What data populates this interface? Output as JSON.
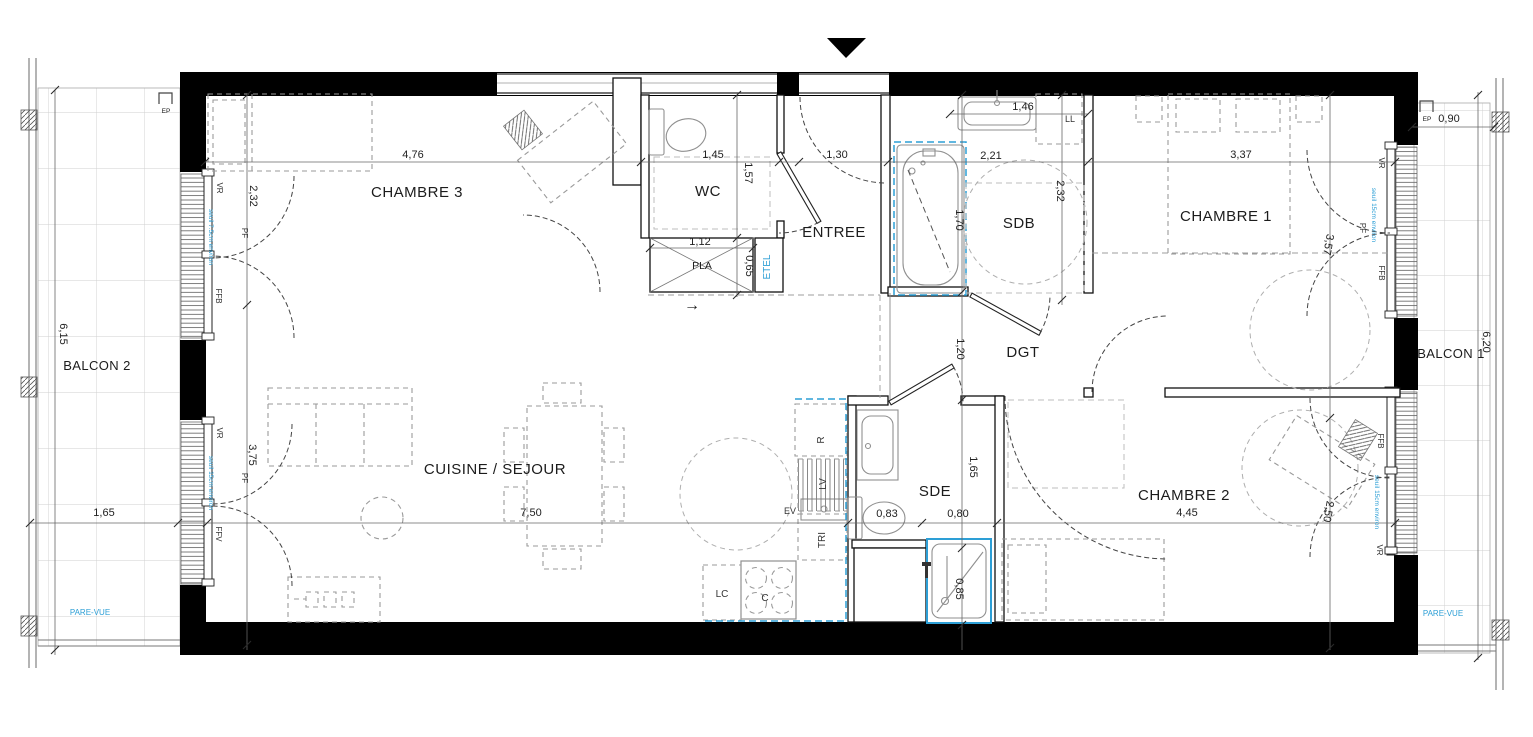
{
  "colors": {
    "accent_blue": "#2D9FD6",
    "wall_black": "#000000"
  },
  "rooms": {
    "chambre3": "CHAMBRE 3",
    "wc": "WC",
    "pla": "PLA",
    "entree": "ENTREE",
    "sdb": "SDB",
    "chambre1": "CHAMBRE 1",
    "balcon2": "BALCON 2",
    "balcon1": "BALCON 1",
    "cuisine_sejour": "CUISINE / SEJOUR",
    "dgt": "DGT",
    "sde": "SDE",
    "chambre2": "CHAMBRE 2"
  },
  "dimensions": {
    "chambre3_w": "4,76",
    "chambre3_d": "2,32",
    "wc_w": "1,45",
    "wc_d": "1,57",
    "pla_w": "1,12",
    "pla_d": "0,65",
    "entree_w": "1,30",
    "sdb_sink": "1,46",
    "sdb_w": "2,21",
    "sdb_d": "2,32",
    "bath": "1,70",
    "chambre1_w": "3,37",
    "chambre1_d": "3,57",
    "balcon2_d": "6,15",
    "balcon2_w": "1,65",
    "balcon1_d": "6,20",
    "balcon1_w": "0,90",
    "sejour_d": "3,75",
    "cuisine_w": "7,50",
    "dgt_d": "1,20",
    "sde_d": "1,65",
    "sde_w1": "0,83",
    "sde_w2": "0,80",
    "shower": "0,85",
    "chambre2_w": "4,45",
    "chambre2_d": "2,50"
  },
  "equipment": {
    "ll": "LL",
    "etel": "ETEL",
    "r": "R",
    "lv": "LV",
    "ev": "EV",
    "tri": "TRI",
    "lc": "LC",
    "c": "C"
  },
  "window_labels": {
    "vr": "VR",
    "pf": "PF",
    "ffb": "FFB",
    "ffv": "FFV",
    "ep": "EP",
    "seuil_7_5": "seuil 7.5cm environ",
    "seuil_15": "seuil 15cm environ"
  },
  "annotations": {
    "pare_vue": "PARE-VUE",
    "direction_arrow": "→"
  }
}
